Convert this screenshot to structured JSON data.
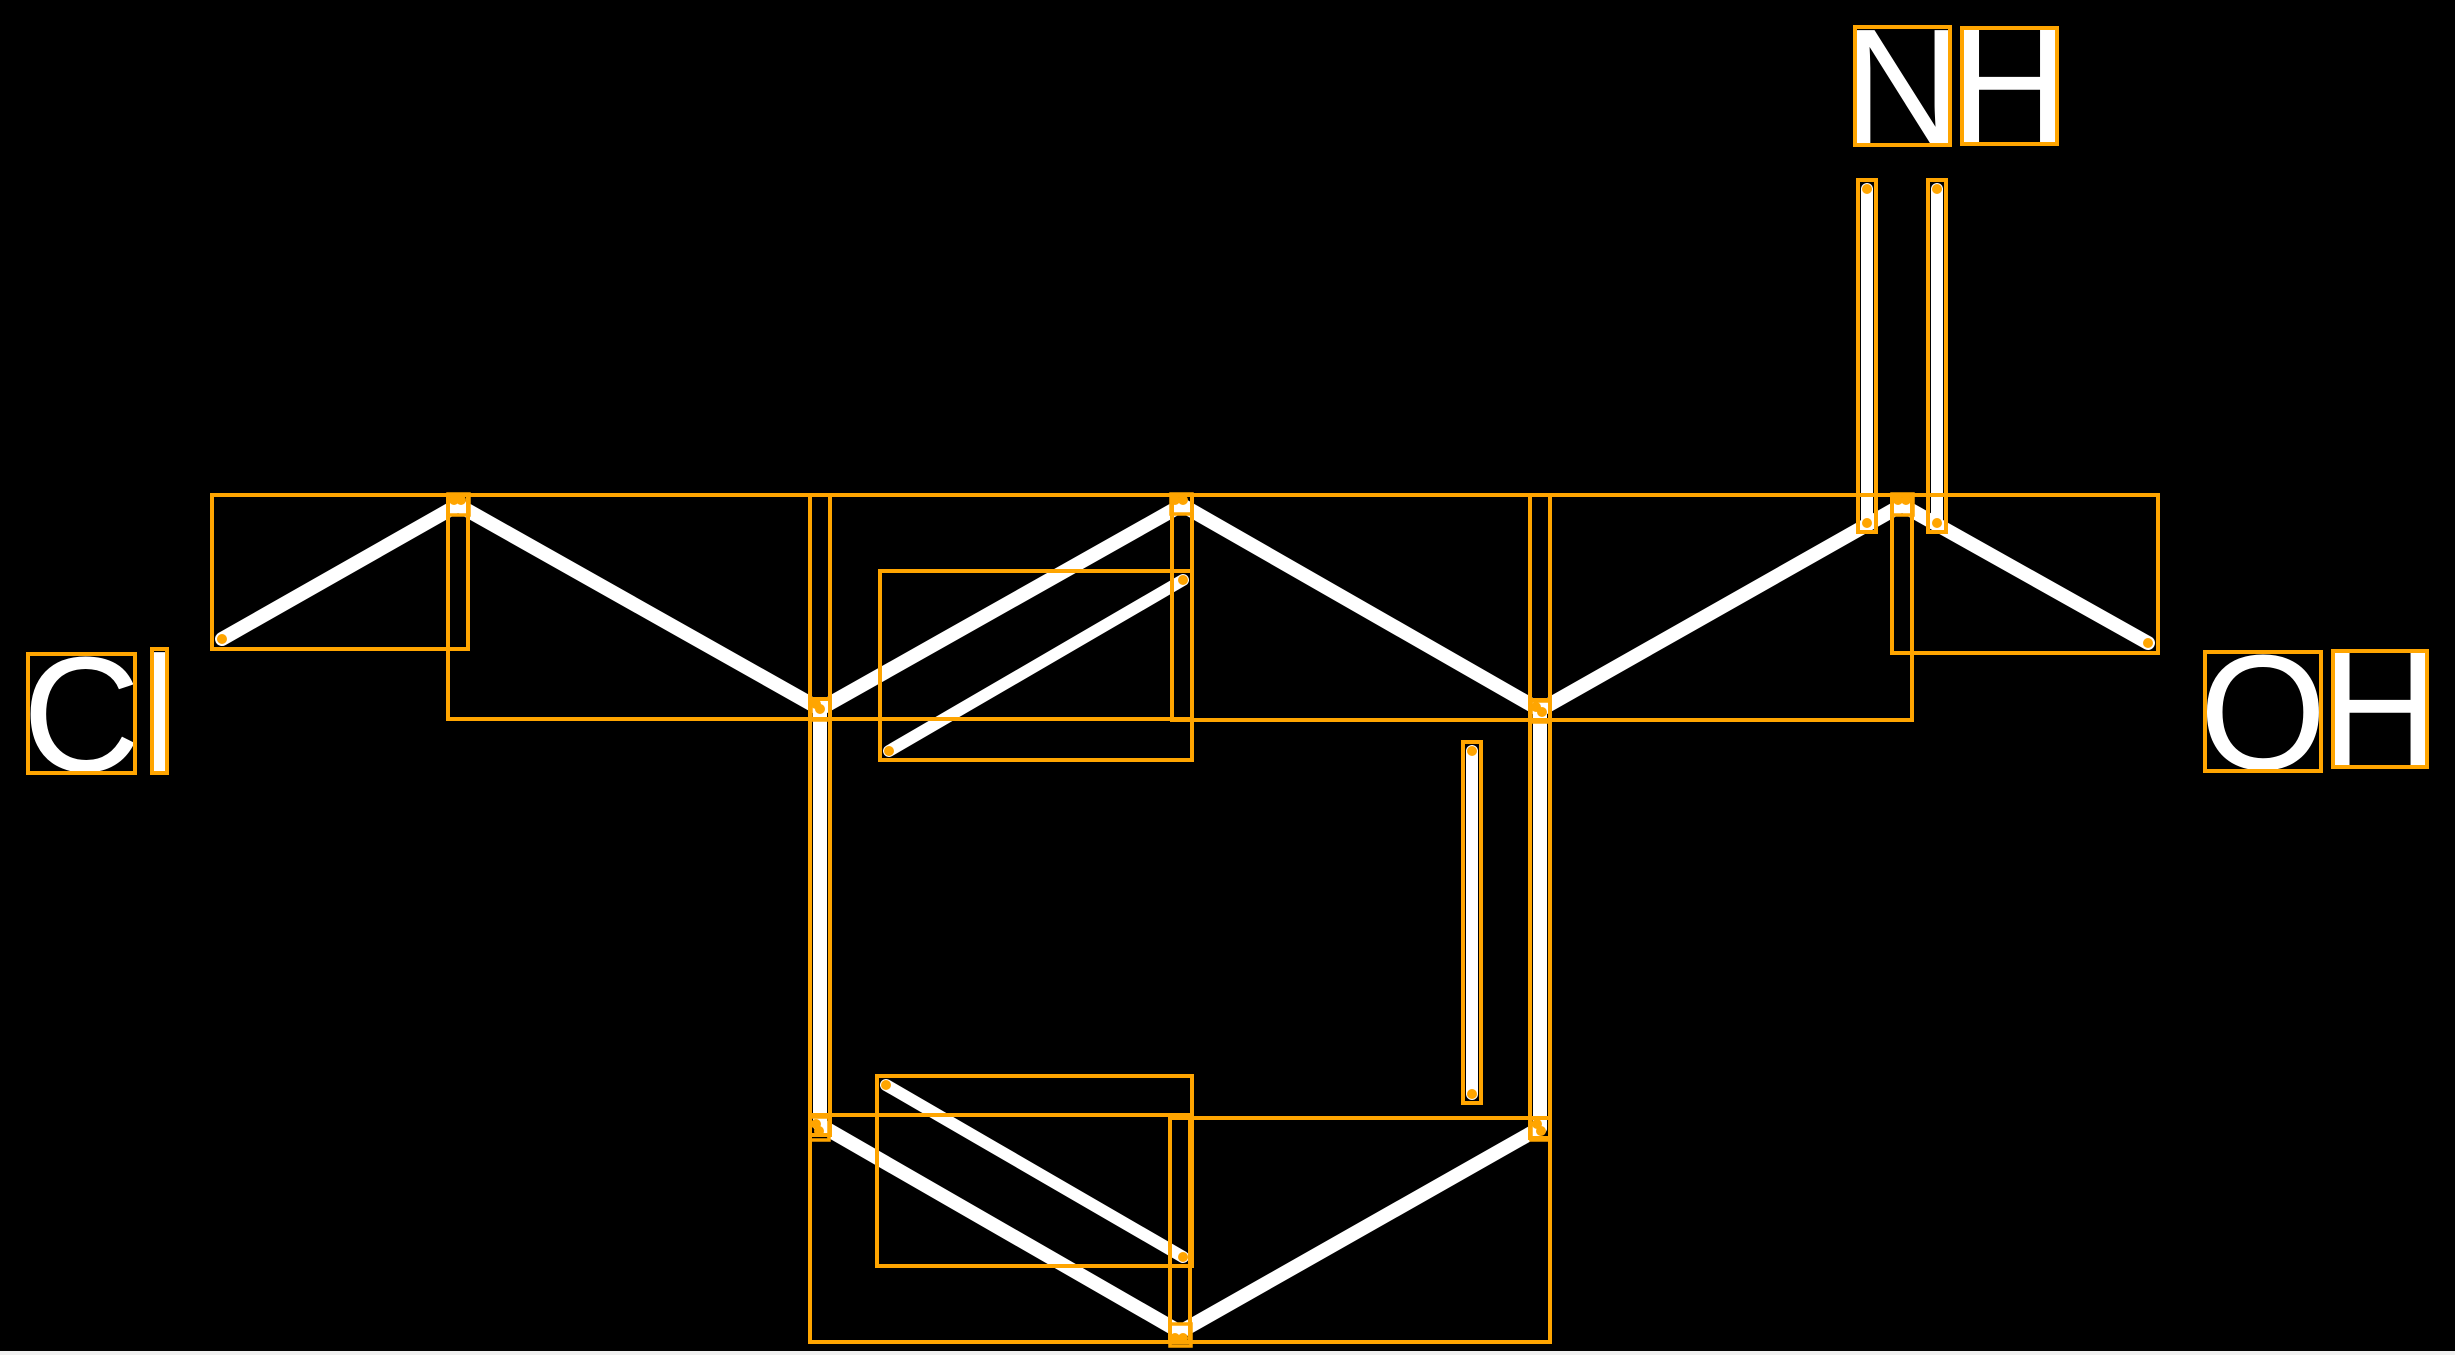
{
  "image": {
    "width": 2455,
    "height": 1355
  },
  "colors": {
    "background": "#000000",
    "bond": "#ffffff",
    "label_text": "#ffffff",
    "annotation": "#ffa500",
    "bottom_strip": "#f0f0f0"
  },
  "atom_labels": [
    {
      "id": "imine-n",
      "text": "N",
      "box": [
        1855,
        27,
        95,
        118
      ]
    },
    {
      "id": "imine-h",
      "text": "H",
      "box": [
        1962,
        28,
        95,
        116
      ]
    },
    {
      "id": "chloro-c",
      "text": "C",
      "box": [
        28,
        654,
        107,
        119
      ]
    },
    {
      "id": "chloro-l",
      "text": "l",
      "box": [
        152,
        649,
        15,
        124
      ]
    },
    {
      "id": "hydroxy-o",
      "text": "O",
      "box": [
        2205,
        652,
        116,
        119
      ]
    },
    {
      "id": "hydroxy-h",
      "text": "H",
      "box": [
        2333,
        651,
        94,
        116
      ]
    }
  ],
  "bonds": [
    {
      "id": "cl-to-ch2",
      "x1": 222,
      "y1": 639,
      "x2": 458,
      "y2": 505,
      "w": 14
    },
    {
      "id": "ch2-to-ring",
      "x1": 458,
      "y1": 505,
      "x2": 820,
      "y2": 709,
      "w": 14
    },
    {
      "id": "ring-top-left",
      "x1": 820,
      "y1": 709,
      "x2": 1182,
      "y2": 505,
      "w": 14
    },
    {
      "id": "ring-top-right",
      "x1": 1182,
      "y1": 505,
      "x2": 1540,
      "y2": 710,
      "w": 14
    },
    {
      "id": "ring-left-vertical",
      "x1": 820,
      "y1": 709,
      "x2": 820,
      "y2": 1125,
      "w": 14
    },
    {
      "id": "ring-right-vertical",
      "x1": 1540,
      "y1": 710,
      "x2": 1540,
      "y2": 1128,
      "w": 14
    },
    {
      "id": "ring-bottom-left",
      "x1": 820,
      "y1": 1125,
      "x2": 1180,
      "y2": 1332,
      "w": 14
    },
    {
      "id": "ring-bottom-right",
      "x1": 1180,
      "y1": 1332,
      "x2": 1540,
      "y2": 1128,
      "w": 14
    },
    {
      "id": "ring-to-imine-c",
      "x1": 1540,
      "y1": 710,
      "x2": 1902,
      "y2": 505,
      "w": 14
    },
    {
      "id": "imine-c-to-oh",
      "x1": 1902,
      "y1": 505,
      "x2": 2148,
      "y2": 643,
      "w": 14
    },
    {
      "id": "ring-double-top",
      "x1": 889,
      "y1": 751,
      "x2": 1183,
      "y2": 580,
      "w": 12
    },
    {
      "id": "ring-double-bottom",
      "x1": 886,
      "y1": 1085,
      "x2": 1183,
      "y2": 1257,
      "w": 12
    },
    {
      "id": "ring-double-right",
      "x1": 1472,
      "y1": 751,
      "x2": 1472,
      "y2": 1094,
      "w": 12
    },
    {
      "id": "imine-double-left",
      "x1": 1867,
      "y1": 189,
      "x2": 1867,
      "y2": 523,
      "w": 12
    },
    {
      "id": "imine-double-right",
      "x1": 1937,
      "y1": 189,
      "x2": 1937,
      "y2": 523,
      "w": 12
    }
  ],
  "vertex_boxes": [
    [
      448,
      494,
      21,
      21
    ],
    [
      811,
      699,
      19,
      21
    ],
    [
      1171,
      494,
      21,
      20
    ],
    [
      1531,
      701,
      19,
      21
    ],
    [
      1892,
      494,
      21,
      21
    ],
    [
      810,
      1117,
      19,
      23
    ],
    [
      1531,
      1118,
      19,
      22
    ],
    [
      1170,
      1324,
      21,
      22
    ]
  ],
  "endpoint_dots": [
    [
      222,
      639
    ],
    [
      2148,
      643
    ],
    [
      454,
      500
    ],
    [
      461,
      500
    ],
    [
      816,
      704
    ],
    [
      820,
      709
    ],
    [
      1175,
      500
    ],
    [
      1183,
      500
    ],
    [
      1536,
      707
    ],
    [
      1542,
      712
    ],
    [
      1898,
      500
    ],
    [
      1906,
      500
    ],
    [
      816,
      1124
    ],
    [
      819,
      1131
    ],
    [
      1537,
      1124
    ],
    [
      1541,
      1131
    ],
    [
      1175,
      1338
    ],
    [
      1183,
      1338
    ],
    [
      889,
      751
    ],
    [
      1183,
      580
    ],
    [
      886,
      1085
    ],
    [
      1183,
      1257
    ],
    [
      1472,
      751
    ],
    [
      1472,
      1094
    ],
    [
      1867,
      189
    ],
    [
      1867,
      523
    ],
    [
      1937,
      189
    ],
    [
      1937,
      523
    ]
  ],
  "annotation_style": {
    "box_stroke_width": 4,
    "dot_radius": 5,
    "bond_box_extra_padding": 3,
    "label_font_size": 164
  },
  "bottom_strip": {
    "x": 0,
    "y": 1351,
    "w": 2455,
    "h": 4
  }
}
